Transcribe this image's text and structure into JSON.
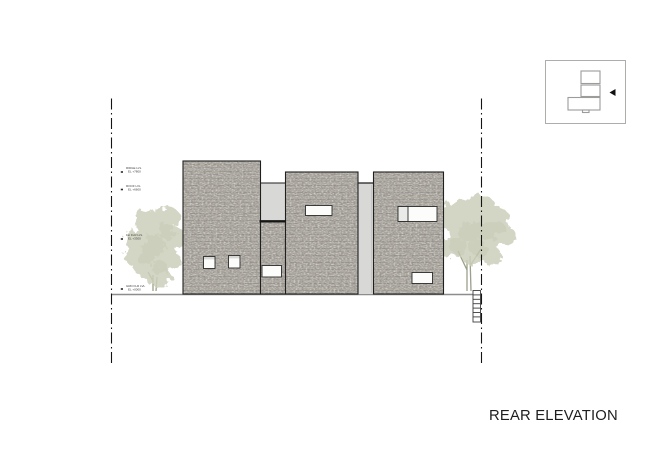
{
  "sheet": {
    "view_title": "REAR ELEVATION",
    "background": "#ffffff"
  },
  "levels": [
    {
      "label": "RIDGE LVL",
      "value": "EL +7800"
    },
    {
      "label": "ROOF LVL",
      "value": "EL +6600"
    },
    {
      "label": "1st FLR LVL",
      "value": "EL +3300"
    },
    {
      "label": "GRD FLR LVL",
      "value": "EL +0000"
    }
  ],
  "key_plan": {
    "view_arrow_direction": "left"
  },
  "colors": {
    "stone_wall": "#aba79f",
    "stone_fleck_dark": "#55514b",
    "recess_panel": "#d8d8d6",
    "outline": "#1f1f1f",
    "ground_line": "#8d8d8b",
    "foliage": "#ccd0ba",
    "foliage_shade": "#bcc1a8",
    "property_line": "#141414",
    "title_text": "#1e1e1e"
  }
}
